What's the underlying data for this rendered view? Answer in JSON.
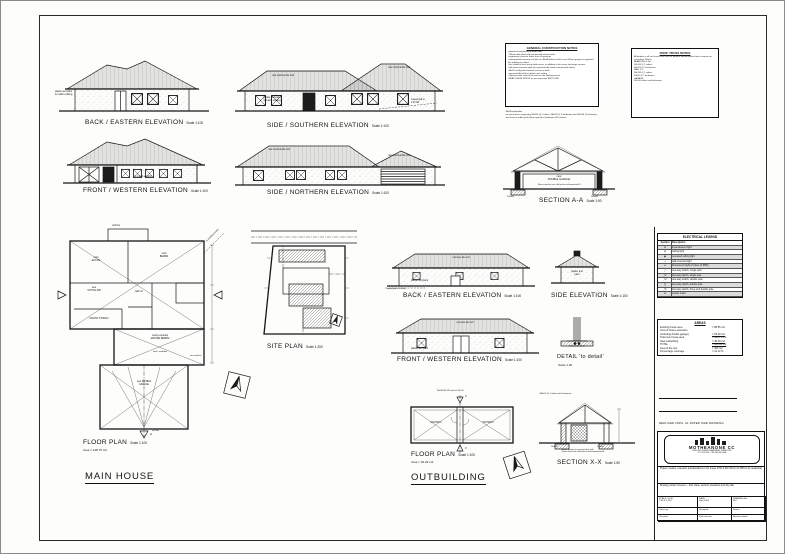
{
  "captions": {
    "e1": {
      "t": "BACK / EASTERN ELEVATION",
      "s": "Scale 1:100"
    },
    "e2": {
      "t": "SIDE / SOUTHERN ELEVATION",
      "s": "Scale 1:100"
    },
    "e3": {
      "t": "FRONT / WESTERN ELEVATION",
      "s": "Scale 1:100"
    },
    "e4": {
      "t": "SIDE / NORTHERN ELEVATION",
      "s": "Scale 1:100"
    },
    "aa": {
      "t": "SECTION A-A",
      "s": "Scale 1:50"
    },
    "fp": {
      "t": "FLOOR PLAN",
      "s": "Scale 1:100",
      "area": "Area = 148.75 m2"
    },
    "mh": "MAIN HOUSE",
    "sp": {
      "t": "SITE PLAN",
      "s": "Scale 1:200"
    },
    "obe1": {
      "t": "BACK / EASTERN ELEVATION",
      "s": "Scale 1:100"
    },
    "se": {
      "t": "SIDE ELEVATION",
      "s": "Scale 1:100"
    },
    "obe2": {
      "t": "FRONT / WESTERN ELEVATION",
      "s": "Scale 1:100"
    },
    "det": {
      "t": "DETAIL 'to detail'",
      "s": "Scale 1:20"
    },
    "obfp": {
      "t": "FLOOR PLAN",
      "s": "Scale 1:100",
      "area": "Area = 36.29 m2"
    },
    "ob": "OUTBUILDING",
    "xx": {
      "t": "SECTION X-X",
      "s": "Scale 1:50"
    }
  },
  "notes": {
    "general": {
      "title": "GENERAL CONSTRUCTION NOTES",
      "body": "-plastered and painted outside walls\n-110mm thick plastered and painted internal walls\n-engineered concrete lintols over all openings\n-waterproofed concrete roof tiles on 38x38 battens laid to max 320mm gauge on approved tile underlay on rafters\n-tiles nailed at least every third course, in addition to the eaves and verge courses\n-half-round concrete ridge tiles grouted with tinted cement-sand mortar\n-38x114 wall plates beneath trusses at walls\n-approved fibre-felt insulation over ceiling\n-exposed rafter ends at the eaves to be well-preserved\n-READ THESE NOTES as per respective SECTIONS",
      "extra": "-38x38 wall-plates\n-on roof trusses comprising 38x114 @ 1 rafters, 38x152 @ 4 tie-beams also 38x114 @ tie-beams\n-roof trusses and/or jack rafters spaced at maximum 760 centres."
    },
    "truss": {
      "title": "ROOF TRUSS NOTES",
      "body": "All timbers to all roof trusses are 38x114 SA pine. All wall plates tied at centres not exceeding 760mm.\nBEAMS 6m & 3m:\n38x114 @ 1 rafters\n38x152 @ 4 tie-beams\nWALL PL:\n38x114 @ 1 rafters\n38x50 @ 1 tie-beams\nGARAGE:\n38x114 rafters and tie-beams."
    }
  },
  "annot": {
    "e1_wall": "plaster and paint\nto match existing",
    "e2_roof1": "new concrete tile roof",
    "e2_roof2": "new concrete tile roof",
    "e2_wall": "plaster and paint\nto match existing",
    "e2_fall": "screed laid to\n1:40 fall",
    "e3_wall": "to match existing",
    "e4_roof1": "new concrete tile roof",
    "e4_roof2": "new concrete tile roof",
    "aa_room": "new\nDOUBLE GARAGE",
    "aa_floor": "30mm screed on conc slab laid on well-compacted fill",
    "aa_foot1": "200x600",
    "aa_foot2": "200x600",
    "obe1_roof": "concrete tile roof",
    "obe1_wall": "plaster and paint",
    "obe1_ground": "paving laid to 1:40 fall",
    "se_wall": "plaster and\npaint",
    "obe2_roof": "concrete tile roof",
    "obe2_wall": "plaster and paint",
    "obfp_top": "38x38x110 SP laid to 1:40 fall",
    "obfp_r1": "OUTRM 1",
    "obfp_r2": "OUTRM 2",
    "obfp_x1": "X",
    "obfp_x2": "X",
    "xx_top": "-38x114 @ 1 rafters and tie-beams.",
    "xx_notes": "-30mm screed on concrete floor slab\n-75mm thick conc slab laid on well-compacted fill",
    "xx_foot1": "200x600",
    "xx_foot2": "200x600",
    "fp": {
      "roofline_top": "roof line",
      "exist_bedrm": "exist\nBEDRM",
      "exist_eatrm": "exist\nEAT RM",
      "bath": "bath rm",
      "sitting": "new\nSITTING RM",
      "porch": "FRONT PORCH",
      "master": "newly extended\nMASTER BEDRM",
      "wardrobe": "exist | wardrobe",
      "garage": "new DOUBLE\nGARAGE",
      "roofline_bot": "roof line",
      "newroof": "new roof line",
      "tohouse": "to existing house",
      "a_marker": "A"
    }
  },
  "legend": {
    "title": "ELECTRICAL LEGEND",
    "col1": "Symbol",
    "col2": "Description",
    "rows": [
      {
        "sym": "⊗",
        "desc": "Incandescent light"
      },
      {
        "sym": "⊕",
        "desc": "ceiling light"
      },
      {
        "sym": "◉",
        "desc": "recessed ceiling light"
      },
      {
        "sym": "◒",
        "desc": "wall-mounted light"
      },
      {
        "sym": "▭",
        "desc": "Fluorescent light (2 tubes of 58W)"
      },
      {
        "sym": "╱",
        "desc": "one-way switch, single pole"
      },
      {
        "sym": "╱2",
        "desc": "two-way switch, single pole"
      },
      {
        "sym": "╱d",
        "desc": "one-way switch, double pole"
      },
      {
        "sym": "╳",
        "desc": "two-way switch, double pole"
      },
      {
        "sym": "╱3",
        "desc": "two-way switch, three and double pole"
      },
      {
        "sym": "⊖",
        "desc": "socket outlet"
      }
    ]
  },
  "areas": {
    "title": "AREAS",
    "rows": [
      {
        "k": "Existing house area",
        "v": "= 85.55 m2"
      },
      {
        "k": "Area of house extension",
        "v": ""
      },
      {
        "k": "(including double garage)",
        "v": "= 63.20 m2"
      },
      {
        "k": "Total new house area",
        "v": "= 148.75 m2"
      },
      {
        "k": "New outbuilding",
        "v": "= 36.29 m2"
      },
      {
        "k": "TOTAL",
        "v": "= 185.04 m2"
      },
      {
        "k": "Area of the site",
        "v": "= 450 m2"
      },
      {
        "k": "Percentage coverage",
        "v": "= 41.12 %"
      }
    ]
  },
  "titleblock": {
    "reduced": "REDUCED 200%, A1 PAPER SIZE DRAWING",
    "logo_name": "MOTHEANONE CC",
    "logo_sub1": "BUILDING PLANS DRAWN AND SUBMITTED",
    "logo_sub2": "P.O. BOX 000 · TEL 000 000 0000",
    "project": "Project: revamp, extension and alterations to the house of Mr & Mrs NN on erf NNN to be residential.",
    "content": "Drawing content covered — floor plans, sections elevations and site plan.",
    "cells": [
      [
        "SCALE: 1:100,\n1:50 & 1:200",
        "DATE:\nSept 2003",
        "DRAWING No:\n010"
      ],
      [
        "Client sig:",
        "Designed",
        "Drawn"
      ],
      [
        "Checked",
        "Date revised",
        "Revision detail"
      ]
    ]
  }
}
